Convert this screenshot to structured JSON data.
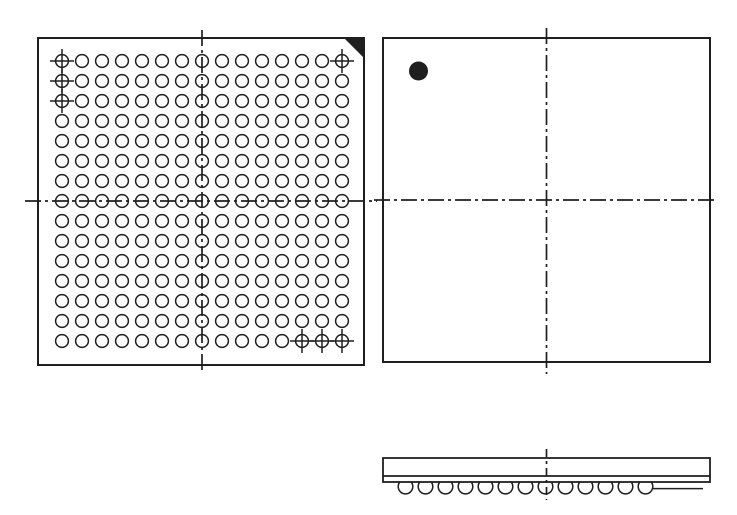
{
  "drawing": {
    "canvas": {
      "width": 737,
      "height": 515,
      "background": "#ffffff"
    },
    "style": {
      "stroke_color": "#1f1f1f",
      "fill_dark": "#1f1f1f",
      "outline_stroke_w": 2,
      "ball_stroke_w": 1.5,
      "centerline_stroke_w": 1.7,
      "centerline_dash": "16 4 3 4",
      "sideview_dash": "8 4 3 4"
    },
    "bottom_view": {
      "outline": {
        "x": 38,
        "y": 38,
        "w": 326,
        "h": 327
      },
      "grid": {
        "rows": 15,
        "cols": 15,
        "first_cx": 62,
        "first_cy": 61,
        "pitch": 20,
        "ball_r": 6.4
      },
      "crosshair_arm": 12,
      "crosshair_balls": [
        {
          "row": 1,
          "col": 1
        },
        {
          "row": 2,
          "col": 1
        },
        {
          "row": 3,
          "col": 1
        },
        {
          "row": 1,
          "col": 15
        },
        {
          "row": 15,
          "col": 13
        },
        {
          "row": 15,
          "col": 14
        },
        {
          "row": 15,
          "col": 15
        }
      ],
      "pin1_triangle_points": "345,39 363,39 363,57",
      "v_centerline": {
        "x": 202,
        "y1": 30,
        "y2": 374
      },
      "h_centerline": {
        "y": 201,
        "x1": 25,
        "x2": 377
      }
    },
    "top_view": {
      "outline": {
        "x": 383,
        "y": 38,
        "w": 327,
        "h": 324
      },
      "pin1_dot": {
        "cx": 418.5,
        "cy": 71,
        "r": 9.5
      },
      "v_centerline": {
        "x": 546.5,
        "y1": 28,
        "y2": 374
      },
      "h_centerline": {
        "y": 200,
        "x1": 374,
        "x2": 717
      }
    },
    "side_view": {
      "body": {
        "x": 383,
        "y": 458,
        "w": 327,
        "h": 24
      },
      "substrate_line_y": 476,
      "balls": {
        "count": 15,
        "first_cx": 405.5,
        "pitch": 20,
        "r": 7.3,
        "center_y": 486.5,
        "top_y": 482,
        "top_half_width": 5.7,
        "flat_y": 488.6,
        "flat_half_width": 6.99
      },
      "flattened_balls": [
        14,
        15
      ],
      "seating_plane_line": {
        "y": 488.6,
        "x1": 652,
        "x2": 703
      },
      "v_centerline": {
        "x": 546.5,
        "y1": 449,
        "y2": 500
      }
    }
  }
}
